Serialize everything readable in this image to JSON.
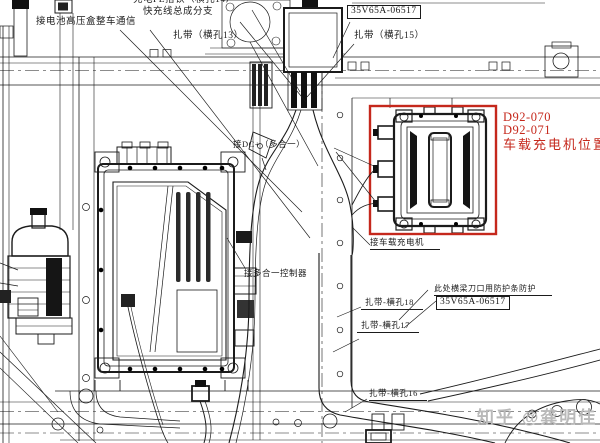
{
  "labels": {
    "battery_comm": "接电池高压盒整车通信",
    "charge_pe_ground": "充电PE搭铁（横孔14）",
    "fast_charge_branch": "快充线总成分支",
    "cable_tie_13": "扎带（横孔13）",
    "part_number_top": "35V65A-06517",
    "cable_tie_15": "扎带（横孔15）",
    "dc_plus": "接DC+（多合一）",
    "controller": "接多合一控制器",
    "charger_connect": "接车载充电机",
    "beam_protection": "此处横梁刀口用防护条防护",
    "part_number_mid": "35V65A-06517",
    "cable_tie_18": "扎带-横孔18",
    "cable_tie_17": "扎带-横孔17",
    "cable_tie_16": "扎带-横孔16"
  },
  "highlight": {
    "code_1": "D92-070",
    "code_2": "D92-071",
    "caption": "车载充电机位置",
    "color": "#c5281c"
  },
  "watermark": {
    "text": "知乎 @龚明佳",
    "color": "#b9b9b9"
  },
  "colors": {
    "line": "#1b1b1b",
    "background": "#ffffff"
  }
}
